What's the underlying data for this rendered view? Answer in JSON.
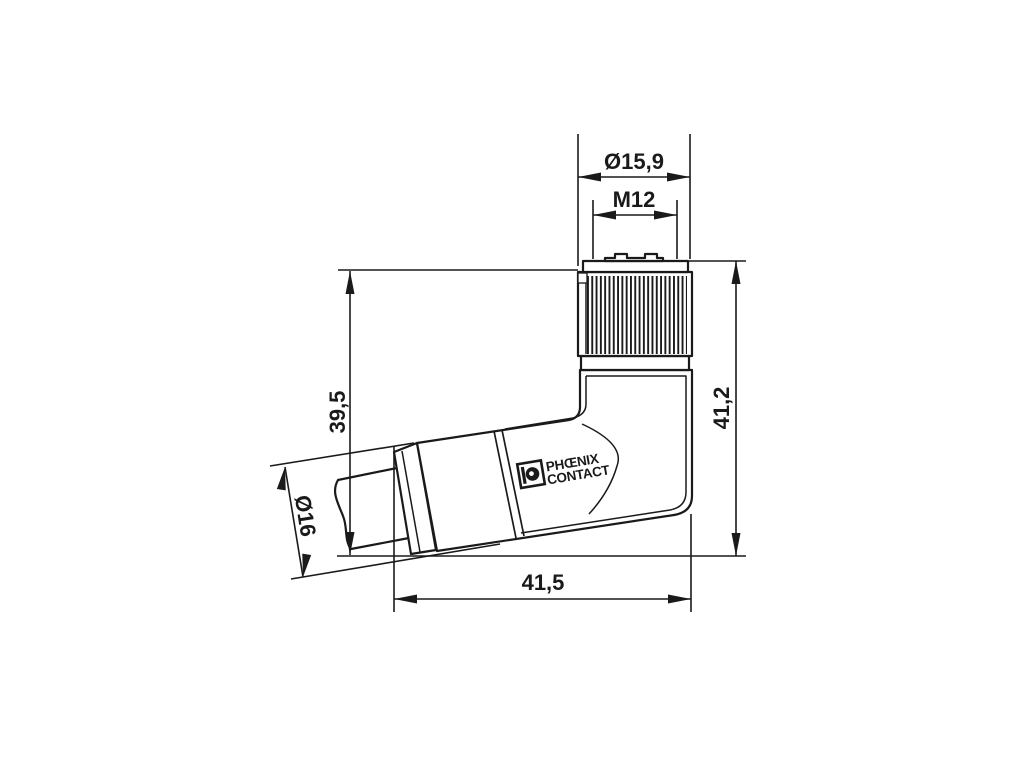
{
  "page": {
    "background": "#ffffff",
    "ink": "#1a1a1a"
  },
  "drawing": {
    "type": "technical-dimension-drawing",
    "subject": "M12 female right-angle connector, side view with cable",
    "brand": {
      "line1": "PHŒNIX",
      "line2": "CONTACT"
    },
    "dimensions": {
      "connector_diameter": "Ø15,9",
      "thread": "M12",
      "height_to_top": "39,5",
      "overall_height": "41,2",
      "cable_entry_diameter": "Ø16",
      "overall_width": "41,5"
    }
  }
}
